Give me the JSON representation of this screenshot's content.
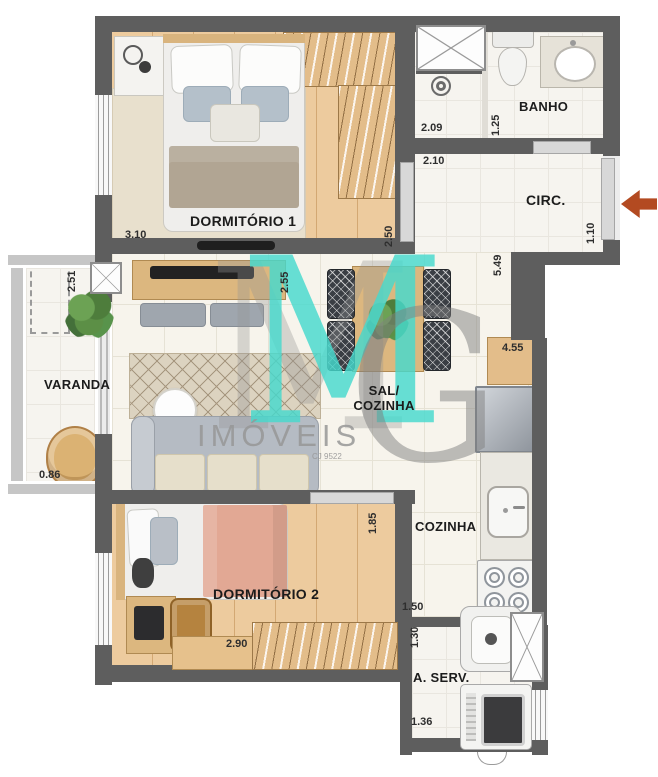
{
  "rooms": {
    "dormitorio1": "DORMITÓRIO 1",
    "dormitorio2": "DORMITÓRIO 2",
    "banho": "BANHO",
    "circulacao": "CIRC.",
    "varanda": "VARANDA",
    "sala_line1": "SAL/",
    "sala_line2": "COZINHA",
    "cozinha": "COZINHA",
    "area_servico": "A. SERV."
  },
  "dimensions": {
    "dorm1_width": "3.10",
    "dorm1_depth": "2.50",
    "banho_shower_width": "2.09",
    "banho_depth": "1.25",
    "circ_top": "2.10",
    "circ_length": "5.49",
    "circ_entry": "1.10",
    "varanda_depth": "2.51",
    "varanda_width": "0.86",
    "sala_depth": "2.55",
    "cozinha_length": "4.55",
    "dorm2_depth": "1.85",
    "dorm2_width": "2.90",
    "cozinha_width": "1.50",
    "aserv_depth": "1.30",
    "aserv_width": "1.36"
  },
  "watermark": {
    "initial_m": "M",
    "initial_g": "G",
    "brand": "IMÓVEIS",
    "registry": "CJ 9522"
  },
  "colors": {
    "wall": "#5e5e5e",
    "wood_floor": "#edcb9e",
    "tile_floor": "#f7f4ec",
    "watermark_teal": "#46d9cd",
    "watermark_gray": "#9b9b9b",
    "entry_arrow": "#b34a21"
  }
}
